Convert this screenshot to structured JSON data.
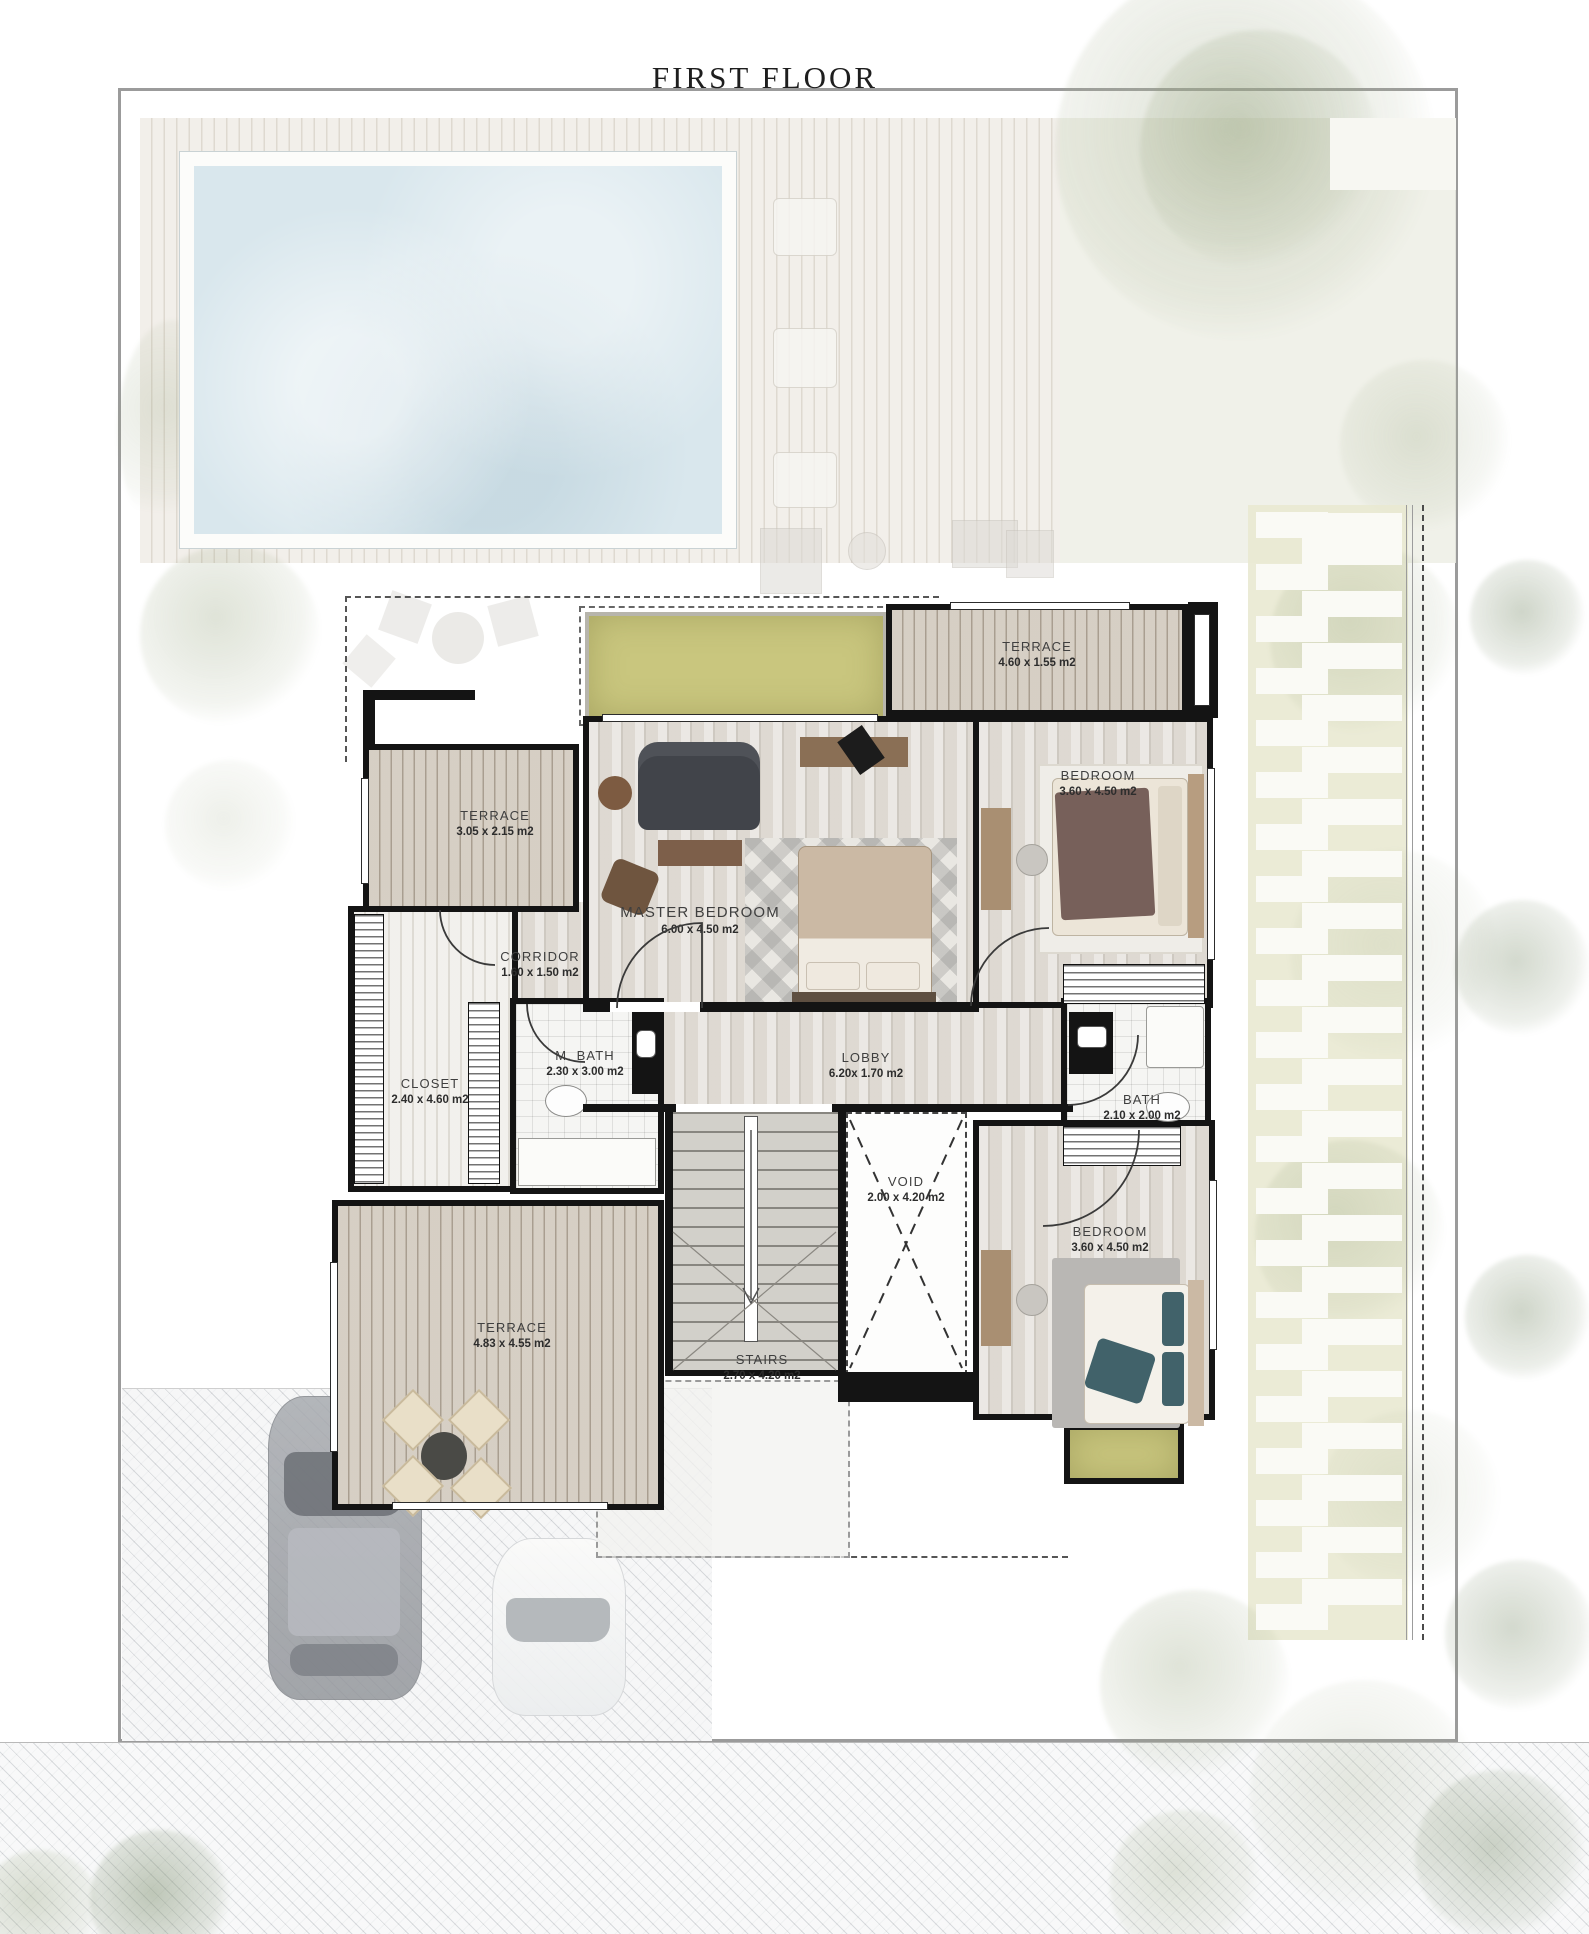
{
  "title": "FIRST FLOOR",
  "rooms": {
    "terrace_tr": {
      "name": "TERRACE",
      "dims": "4.60 x 1.55 m2"
    },
    "bedroom_tr": {
      "name": "BEDROOM",
      "dims": "3.60 x 4.50 m2"
    },
    "terrace_left": {
      "name": "TERRACE",
      "dims": "3.05 x 2.15 m2"
    },
    "master_bedroom": {
      "name": "MASTER BEDROOM",
      "dims": "6.00 x 4.50 m2"
    },
    "corridor": {
      "name": "CORRIDOR",
      "dims": "1.60 x 1.50 m2"
    },
    "closet": {
      "name": "CLOSET",
      "dims": "2.40 x 4.60 m2"
    },
    "m_bath": {
      "name": "M. BATH",
      "dims": "2.30 x 3.00 m2"
    },
    "lobby": {
      "name": "LOBBY",
      "dims": "6.20x 1.70 m2"
    },
    "bath": {
      "name": "BATH",
      "dims": "2.10 x 2.00 m2"
    },
    "void": {
      "name": "VOID",
      "dims": "2.00 x 4.20 m2"
    },
    "bedroom_br": {
      "name": "BEDROOM",
      "dims": "3.60 x 4.50 m2"
    },
    "terrace_bl": {
      "name": "TERRACE",
      "dims": "4.83 x 4.55 m2"
    },
    "stairs": {
      "name": "STAIRS",
      "dims": "2.70 x 4.20 m2"
    }
  },
  "colors": {
    "wall": "#141414",
    "wood_floor": "#e0dcd5",
    "terrace_deck": "#c9bfb1",
    "grass": "#c9c67e",
    "pool_water": "#d9e7ed",
    "tile": "#f5f5f3",
    "teal_accent": "#41626a",
    "site_frame": "#9b9b9b"
  }
}
